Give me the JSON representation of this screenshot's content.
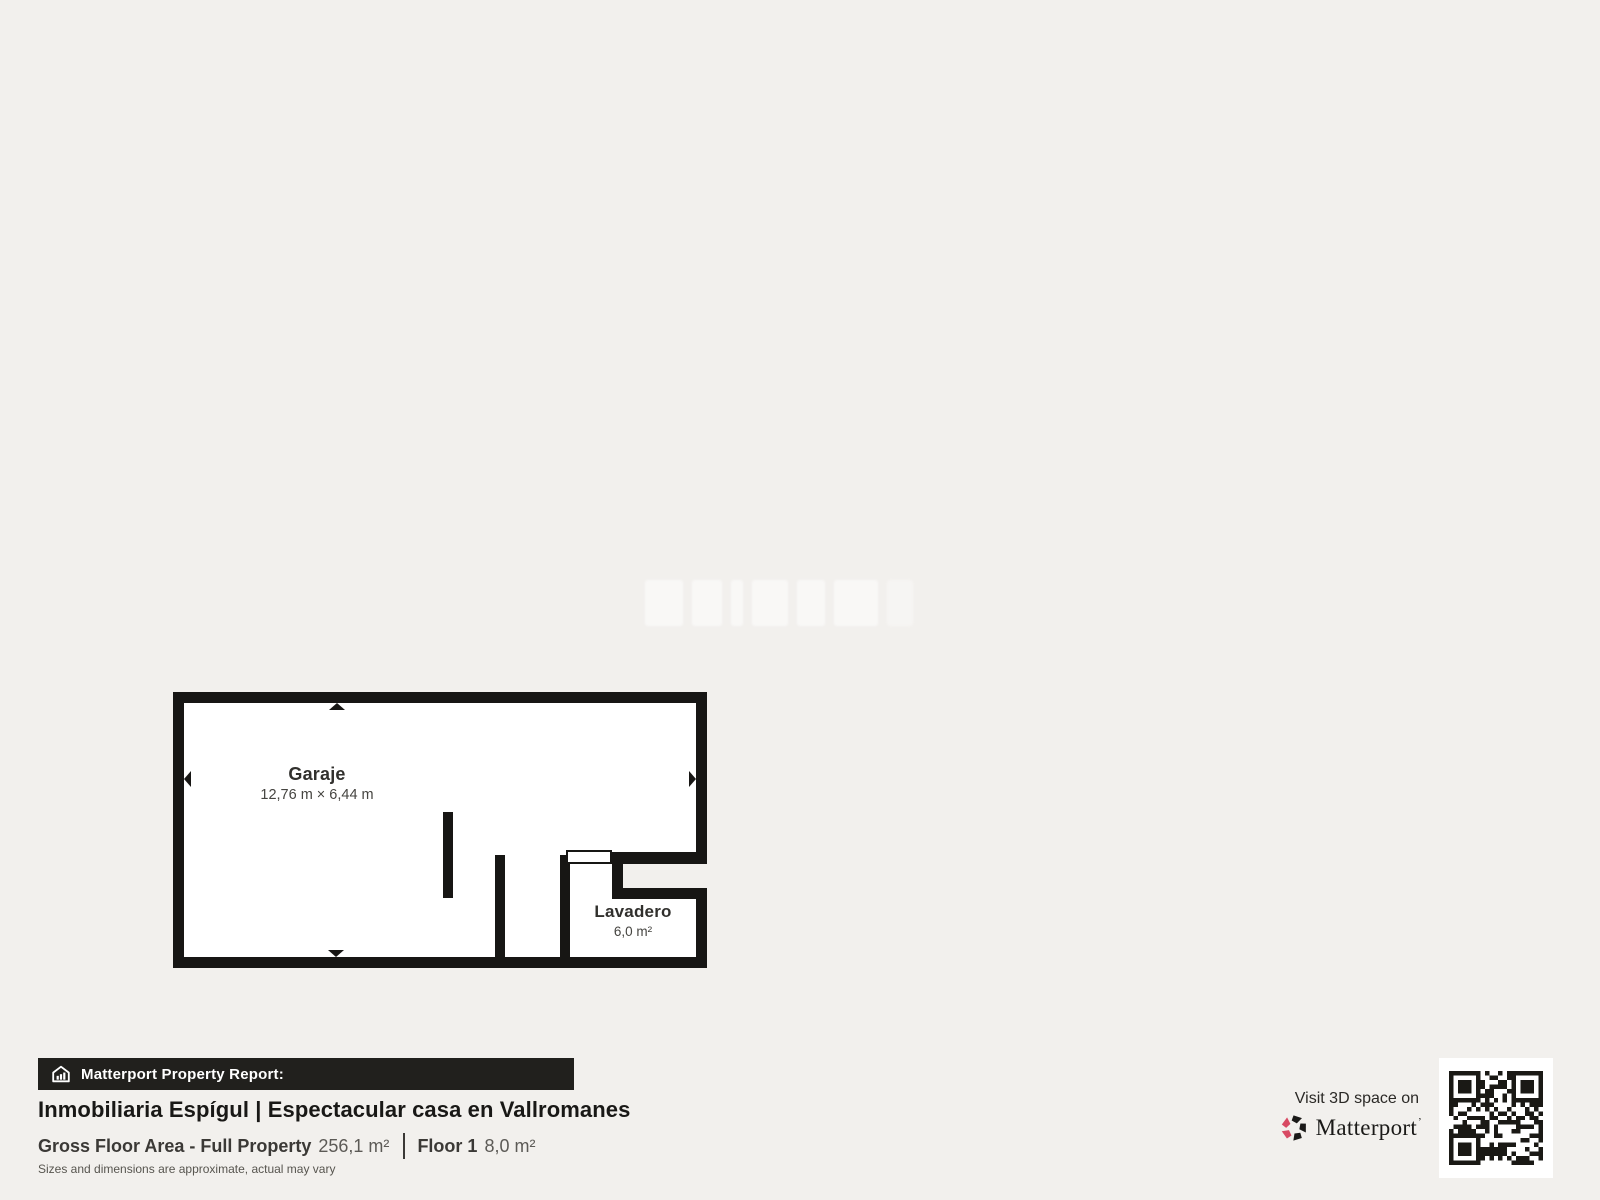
{
  "floorplan": {
    "rooms": [
      {
        "name": "Garaje",
        "dimensions": "12,76 m × 6,44 m"
      },
      {
        "name": "Lavadero",
        "area": "6,0 m²"
      }
    ],
    "wall_color": "#171614",
    "floor_color": "#ffffff"
  },
  "footer": {
    "report_bar": {
      "label": "Matterport Property Report:",
      "icon": "house-chart-icon",
      "background": "#21201d"
    },
    "title": "Inmobiliaria Espígul | Espectacular casa en Vallromanes",
    "metrics": [
      {
        "label": "Gross Floor Area - Full Property",
        "value": "256,1 m²"
      },
      {
        "label": "Floor 1",
        "value": "8,0 m²"
      }
    ],
    "disclaimer": "Sizes and dimensions are approximate, actual may vary"
  },
  "visit_panel": {
    "text": "Visit 3D space on",
    "brand": "Matterport",
    "trademark_mark": "’",
    "logo_pink": "#d84a63",
    "logo_black": "#1b1a18",
    "qr_icon": "qr-code"
  }
}
